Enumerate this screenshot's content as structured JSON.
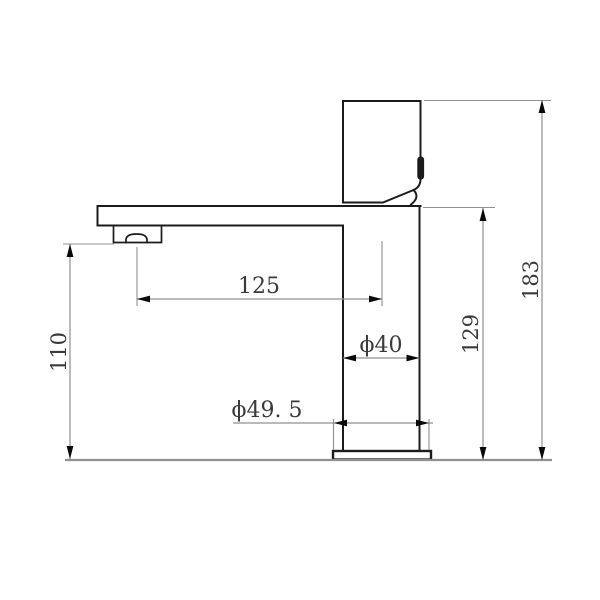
{
  "drawing": {
    "subject": "faucet-side-elevation-technical-drawing"
  },
  "dims": {
    "spout_reach": {
      "label": "125",
      "value": 125
    },
    "spout_outlet_height": {
      "label": "110",
      "value": 110
    },
    "body_height": {
      "label": "129",
      "value": 129
    },
    "overall_height": {
      "label": "183",
      "value": 183
    },
    "body_diameter": {
      "label": "ϕ40",
      "value": 40
    },
    "base_diameter": {
      "label": "ϕ49. 5",
      "value": 49.5
    }
  },
  "colors": {
    "outline": "#1b1b1b",
    "dim": "#909090",
    "arrow": "#0a0a0a",
    "text": "#3a3a3a",
    "bg": "#ffffff"
  }
}
